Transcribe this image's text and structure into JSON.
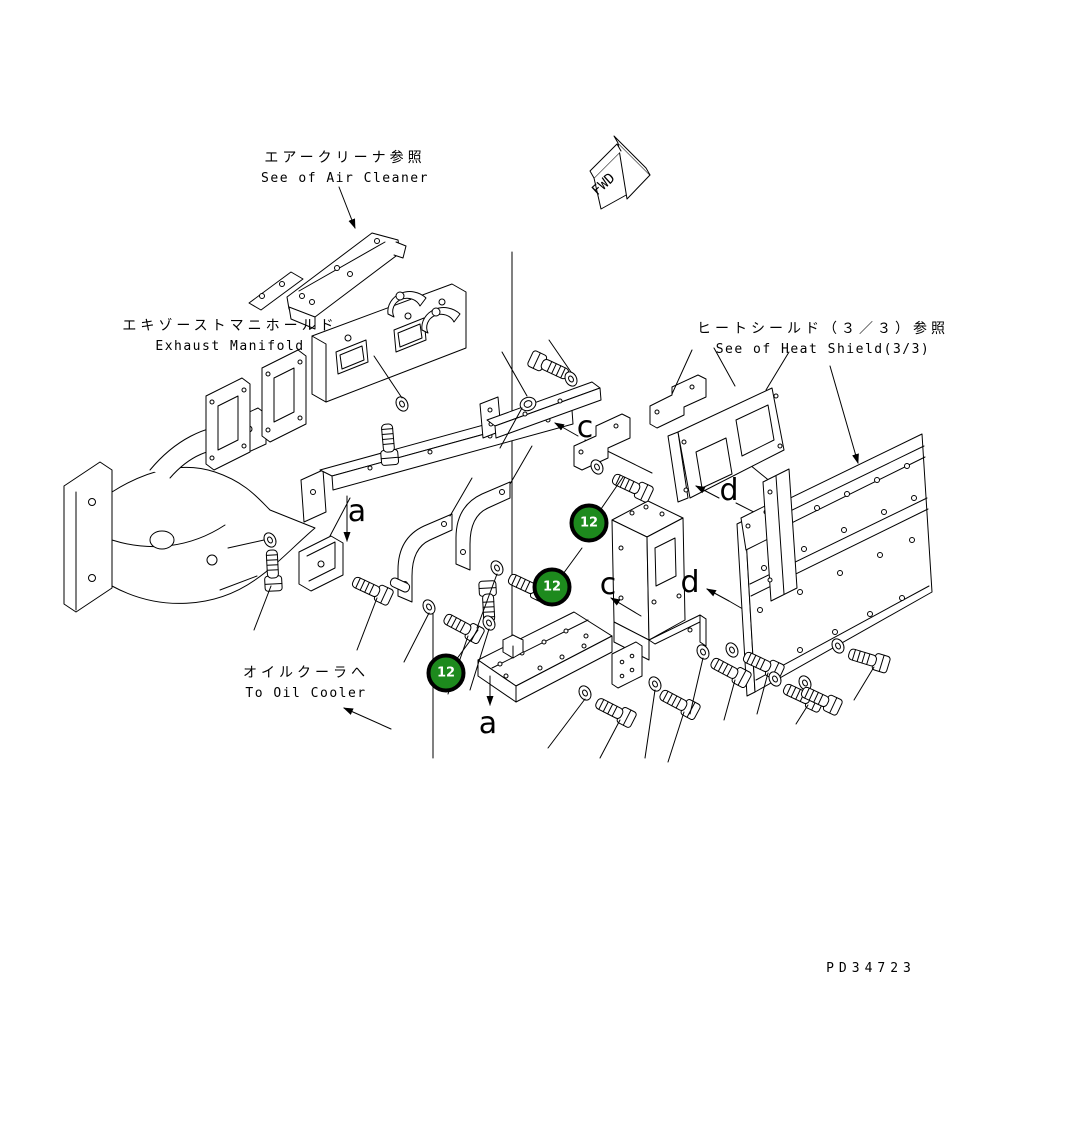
{
  "page": {
    "width": 1082,
    "height": 1124,
    "background": "#ffffff"
  },
  "drawing_number": "PD34723",
  "direction_indicator": {
    "label": "FWD"
  },
  "labels": {
    "air_cleaner": {
      "jp": "エアークリーナ参照",
      "en": "See of Air Cleaner"
    },
    "exhaust_manifold": {
      "jp": "エキゾーストマニホールド",
      "en": "Exhaust Manifold"
    },
    "heat_shield": {
      "jp": "ヒートシールド（３／３）参照",
      "en": "See of Heat Shield(3/3)"
    },
    "oil_cooler": {
      "jp": "オイルクーラへ",
      "en": "To Oil Cooler"
    }
  },
  "balloons": [
    {
      "number": "12",
      "x": 589,
      "y": 523
    },
    {
      "number": "12",
      "x": 552,
      "y": 587
    },
    {
      "number": "12",
      "x": 446,
      "y": 673
    }
  ],
  "callouts": [
    {
      "letter": "a",
      "x": 357,
      "y": 512
    },
    {
      "letter": "c",
      "x": 585,
      "y": 428
    },
    {
      "letter": "d",
      "x": 729,
      "y": 491
    },
    {
      "letter": "c",
      "x": 608,
      "y": 585
    },
    {
      "letter": "d",
      "x": 690,
      "y": 583
    },
    {
      "letter": "a",
      "x": 488,
      "y": 724
    }
  ],
  "colors": {
    "balloon_fill": "#1d8a1d",
    "balloon_ring": "#000000",
    "balloon_text": "#ffffff",
    "line": "#000000"
  }
}
